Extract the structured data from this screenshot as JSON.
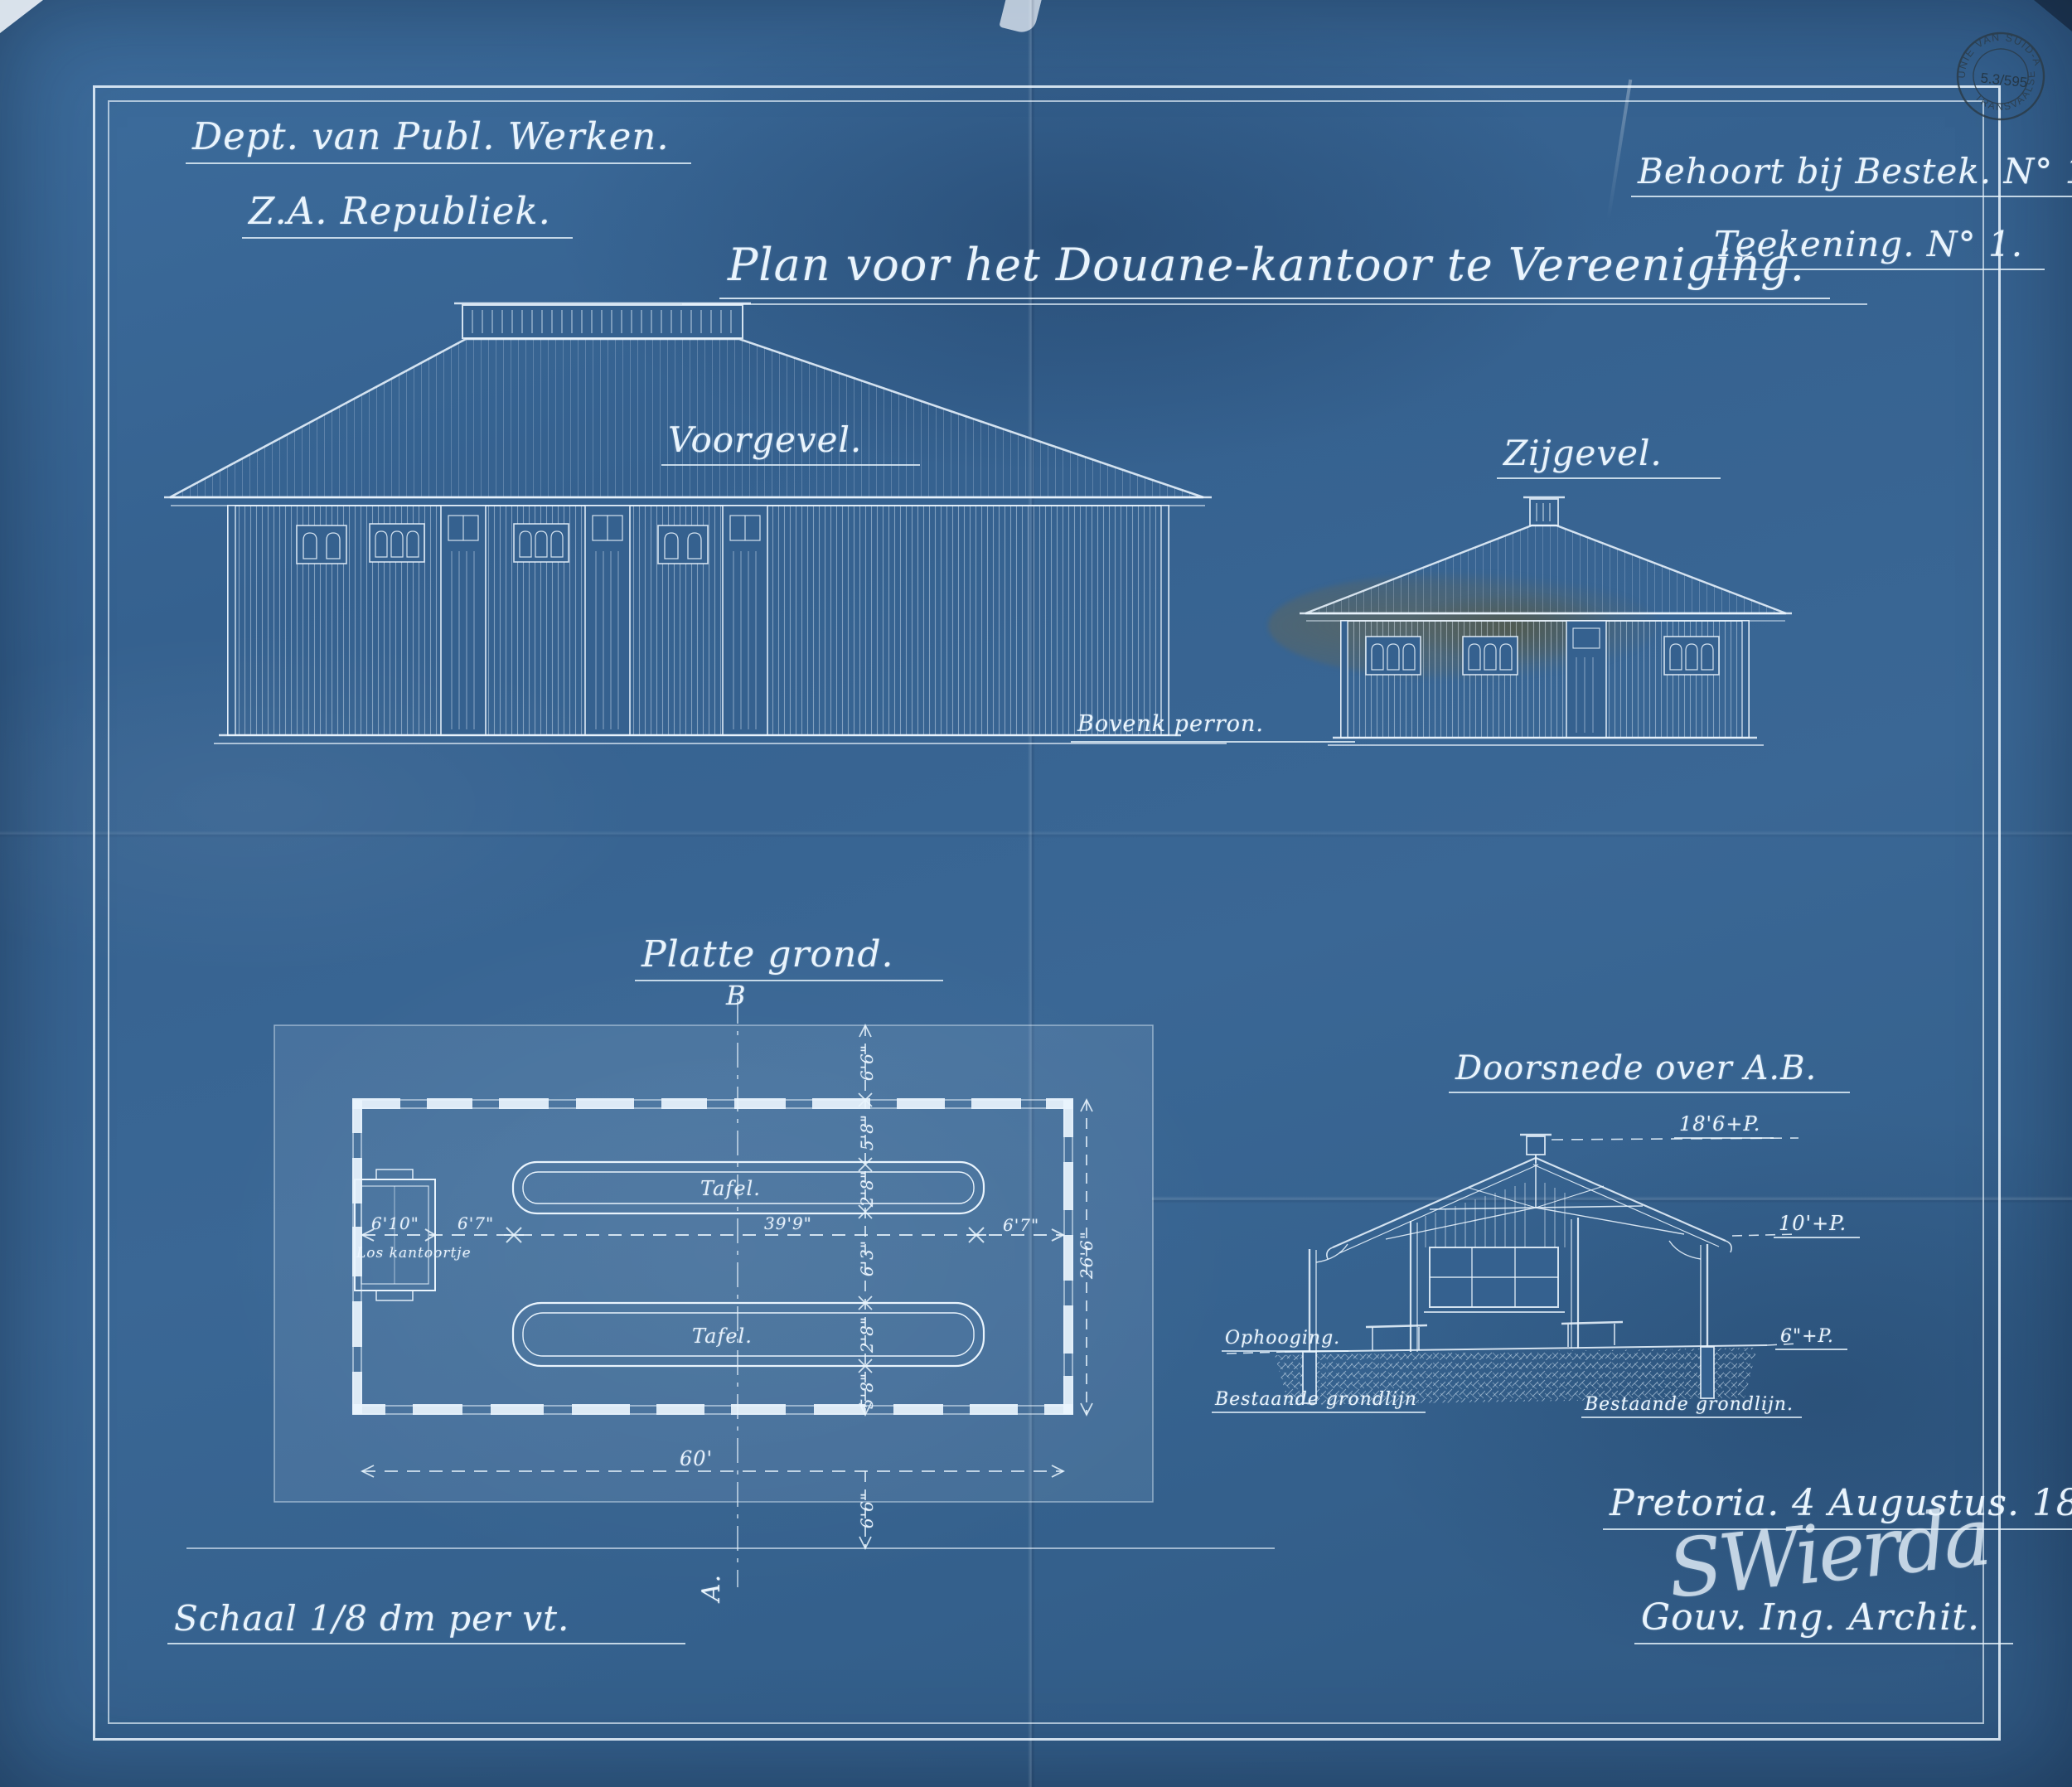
{
  "document": {
    "title": "Plan voor het Douane-kantoor te Vereeniging.",
    "department_line1": "Dept. van Publ. Werken.",
    "department_line2": "Z.A. Republiek.",
    "reference_line1": "Behoort bij Bestek. N° 132.",
    "reference_line2": "Teekening. N° 1.",
    "scale_note": "Schaal 1/8 dm per vt.",
    "place_date": "Pretoria. 4 Augustus. 1892.",
    "signature": "SWierda",
    "signatory_role": "Gouv. Ing. Archit."
  },
  "stamp": {
    "arc_top": "UNIE VAN SUID-AFRIKA",
    "arc_bottom": "TRANSVAALSE ARGIEF",
    "number": "5.3/595"
  },
  "views": {
    "front": {
      "label": "Voorgevel.",
      "platform_note": "Bovenk perron."
    },
    "side": {
      "label": "Zijgevel."
    },
    "plan": {
      "label": "Platte grond.",
      "section_marker_top": "B",
      "section_marker_bottom": "A.",
      "room_label": "Los kantoortje",
      "table_top": "Tafel.",
      "table_bottom": "Tafel.",
      "dims": {
        "office_w": "6'10\"",
        "gap_left": "6'7\"",
        "length_mid": "39'9\"",
        "gap_right": "6'7\"",
        "stoep_top": "6'6\"",
        "front_depth": "5'8\"",
        "table_top_d": "2'8\"",
        "between_tables": "6'3\"",
        "table_bot_d": "2'8\"",
        "back_depth": "5'8\"",
        "stoep_bottom": "6'6\"",
        "total_length": "60'",
        "total_width": "26'6\""
      }
    },
    "section": {
      "label": "Doorsnede over A.B.",
      "level_ridge": "18'6+P.",
      "level_eaves": "10'+P.",
      "level_plinth": "6\"+P.",
      "fill_label": "Ophooging.",
      "ground_left": "Bestaande grondlijn",
      "ground_right": "Bestaande grondlijn."
    }
  },
  "colors": {
    "paper": "#3a6795",
    "ink": "#e9f4fd",
    "stamp_ink": "#2b3a45",
    "stain": "#6f6847"
  }
}
